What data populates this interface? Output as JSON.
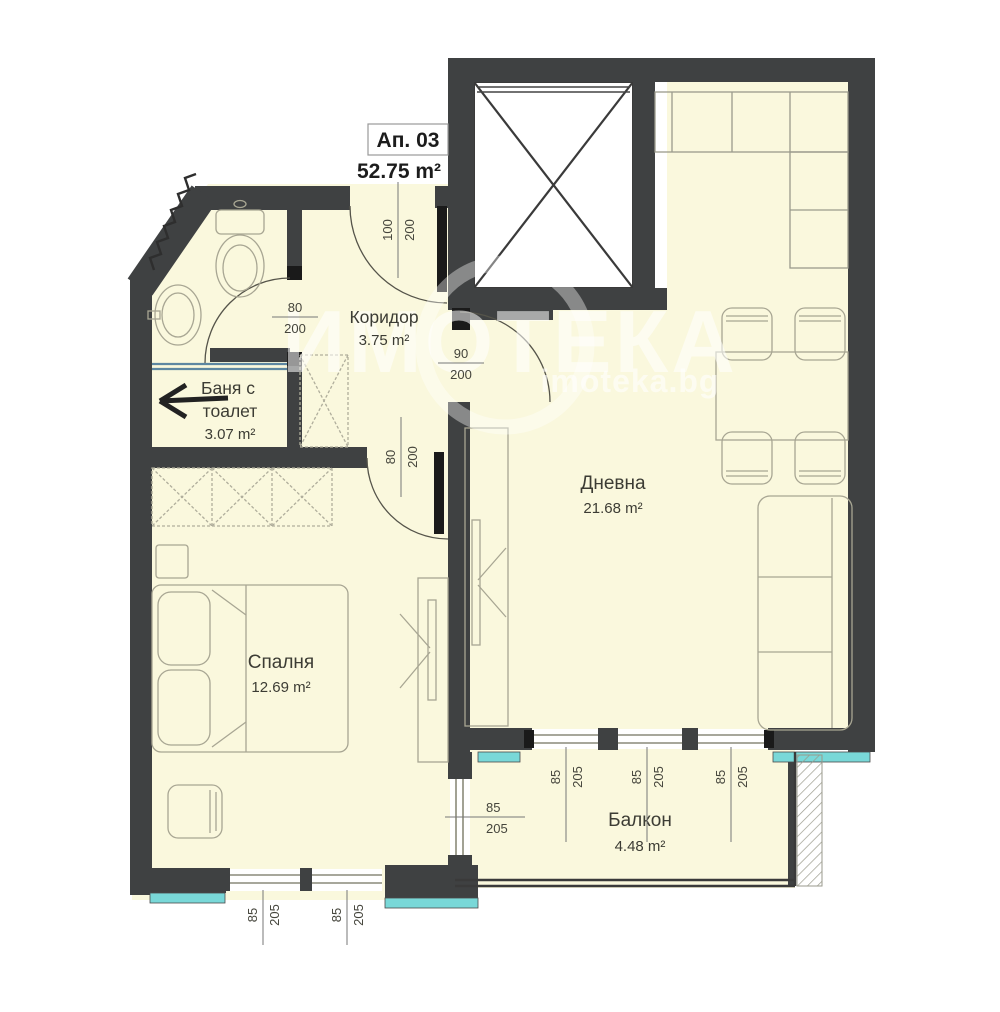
{
  "plan": {
    "title": "Ап. 03",
    "total_area": "52.75 m²",
    "watermark": {
      "brand": "ИМОТЕКА",
      "site": "imoteka.bg"
    },
    "rooms": {
      "corridor": {
        "name": "Коридор",
        "area": "3.75 m²"
      },
      "bathroom": {
        "name_line1": "Баня с",
        "name_line2": "тоалет",
        "area": "3.07 m²"
      },
      "living": {
        "name": "Дневна",
        "area": "21.68 m²"
      },
      "bedroom": {
        "name": "Спалня",
        "area": "12.69 m²"
      },
      "balcony": {
        "name": "Балкон",
        "area": "4.48 m²"
      }
    },
    "dimensions": {
      "entrance_door": {
        "w": "100",
        "h": "200"
      },
      "bath_door": {
        "w": "80",
        "h": "200"
      },
      "living_door": {
        "w": "90",
        "h": "200"
      },
      "bedroom_door": {
        "w": "80",
        "h": "200"
      },
      "balcony_window_1": {
        "w": "85",
        "h": "205"
      },
      "balcony_window_2": {
        "w": "85",
        "h": "205"
      },
      "balcony_window_3": {
        "w": "85",
        "h": "205"
      },
      "balcony_side_window": {
        "w": "85",
        "h": "205"
      },
      "bedroom_window_1": {
        "w": "85",
        "h": "205"
      },
      "bedroom_window_2": {
        "w": "85",
        "h": "205"
      }
    },
    "colors": {
      "floor": "#faf8dd",
      "wall": "#3f4142",
      "door_leaf": "#1a1a1a",
      "insulation": "#79d8d8",
      "shower_glass": "#5d87a1",
      "furniture_line": "#a8a693"
    }
  }
}
